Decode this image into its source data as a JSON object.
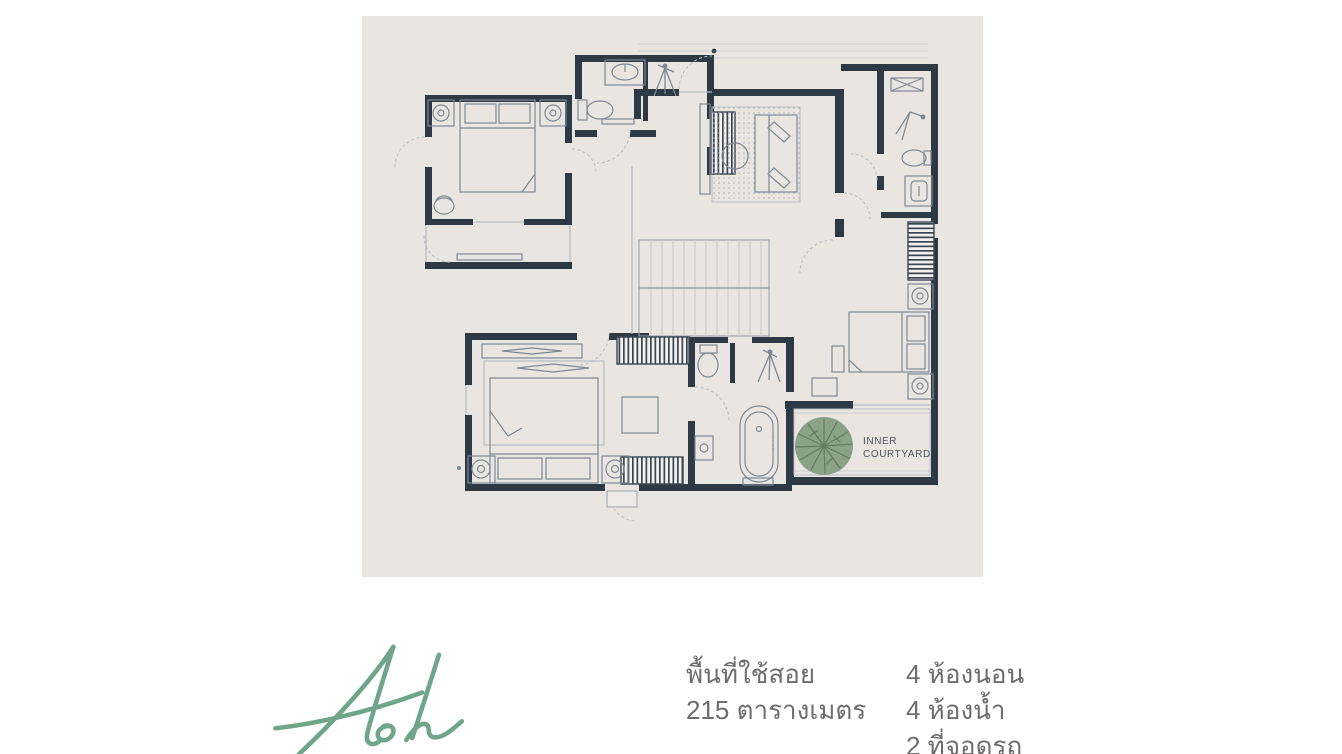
{
  "page": {
    "background": "#ffffff"
  },
  "floorplan": {
    "panel_color": "#e9e6e1",
    "wall_color": "#2d3944",
    "furniture_line_color": "#7e8894",
    "light_line_color": "#c3c8cd",
    "courtyard": {
      "label_line1": "INNER",
      "label_line2": "COURTYARD",
      "label_color": "#4b5560",
      "tree_color": "#8ca287",
      "tree_branch_color": "#617a5f"
    }
  },
  "logo": {
    "text": "Ash",
    "color": "#6fa58a"
  },
  "specs": {
    "text_color": "#6d6d6d",
    "area_label": "พื้นที่ใช้สอย",
    "area_value": "215 ตารางเมตร",
    "bedrooms": "4 ห้องนอน",
    "bathrooms": "4 ห้องน้ำ",
    "parking": "2 ที่จอดรถ"
  }
}
